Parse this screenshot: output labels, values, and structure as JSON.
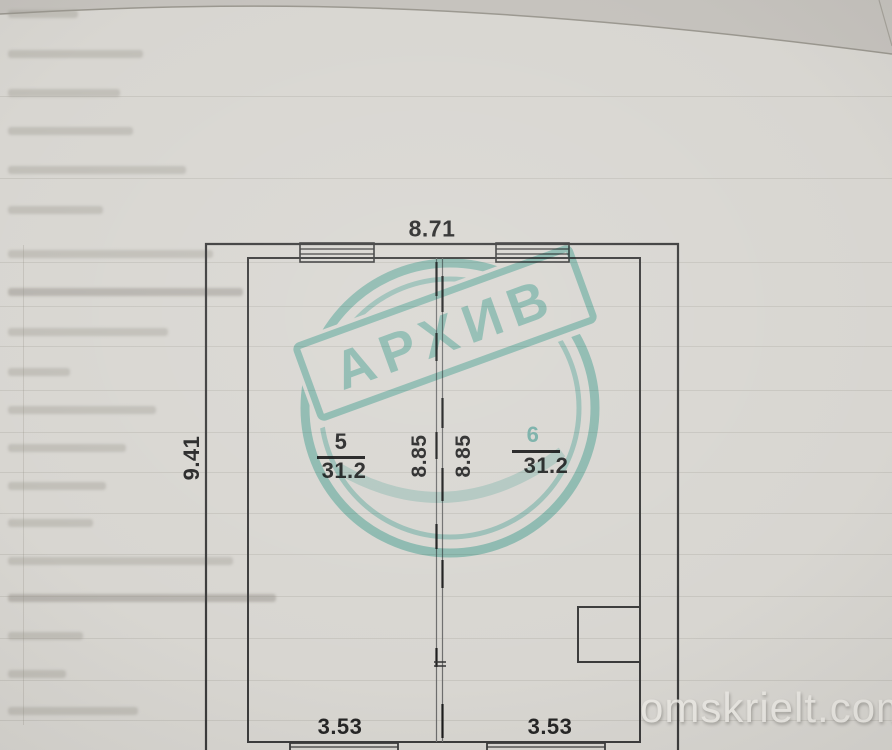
{
  "plan": {
    "dim_top": "8.71",
    "dim_left": "9.41",
    "rooms": [
      {
        "number": "5",
        "area": "31.2",
        "inner_height": "8.85",
        "bottom_width": "3.53"
      },
      {
        "number": "6",
        "area": "31.2",
        "inner_height": "8.85",
        "bottom_width": "3.53"
      }
    ]
  },
  "stamp": {
    "text": "АРХИВ",
    "color": "#8ad2c9"
  },
  "watermark": {
    "text": "omskrielt.com"
  },
  "colors": {
    "wall_line": "#3b3b3b",
    "paper": "#d8d6d1"
  }
}
